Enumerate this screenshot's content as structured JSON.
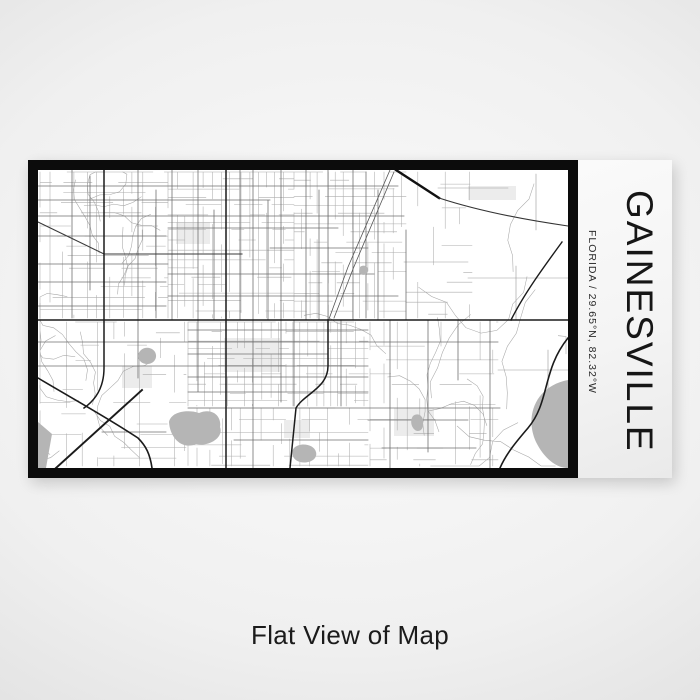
{
  "product": {
    "city": "GAINESVILLE",
    "region_line": "FLORIDA / 29.65°N, 82.32°W",
    "caption": "Flat View of Map"
  },
  "map_colors": {
    "background": "#ffffff",
    "minor_road": "#adadad",
    "walk_road": "#a6a6a6",
    "arterial_road": "#707070",
    "east_road": "#9a9a9a",
    "rail": "#555555",
    "major_road": "#1b1b1b",
    "highway": "#111111",
    "water": "#b5b5b5",
    "park": "#ececec",
    "frame": "#0c0c0c",
    "panel_text": "#161616"
  }
}
